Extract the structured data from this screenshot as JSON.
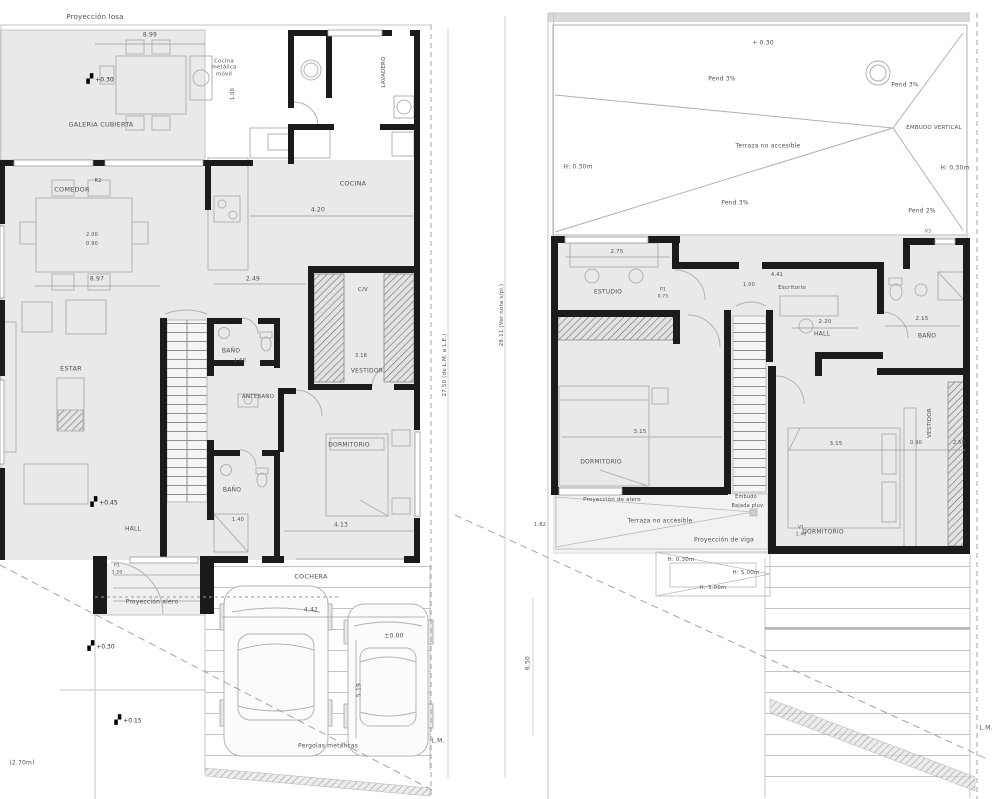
{
  "colors": {
    "wall": "#1b1b1b",
    "furniture_line": "#b3b3b3",
    "dim_line": "#999999",
    "room_fill": "#e9e9e9",
    "text": "#4f4f4f"
  },
  "glyphs": {
    "level_marker": "▞"
  },
  "markers": [
    {
      "t": "+0.30",
      "x": 100,
      "y": 80
    },
    {
      "t": "+0.45",
      "x": 104,
      "y": 503
    },
    {
      "t": "+0.30",
      "x": 101,
      "y": 647
    },
    {
      "t": "+0.15",
      "x": 128,
      "y": 721
    }
  ],
  "labels": [
    {
      "t": "Proyección losa",
      "x": 95,
      "y": 17,
      "s": 7
    },
    {
      "t": "8.99",
      "x": 150,
      "y": 36,
      "s": 6
    },
    {
      "t": "Cocina\nmetálica\nmóvil",
      "x": 224,
      "y": 68,
      "s": 5.5
    },
    {
      "t": "1.00",
      "x": 234,
      "y": 94,
      "s": 5,
      "r": -90
    },
    {
      "t": "GALERIA CUBIERTA",
      "x": 101,
      "y": 125,
      "s": 6.5,
      "n": "room-label-galeria"
    },
    {
      "t": "R2",
      "x": 98,
      "y": 182,
      "s": 5
    },
    {
      "t": "COMEDOR",
      "x": 72,
      "y": 190,
      "s": 6.5,
      "n": "room-label-comedor"
    },
    {
      "t": "2.00",
      "x": 92,
      "y": 236,
      "s": 5
    },
    {
      "t": "0.90",
      "x": 92,
      "y": 245,
      "s": 5
    },
    {
      "t": "8.97",
      "x": 97,
      "y": 280,
      "s": 6
    },
    {
      "t": "ESTAR",
      "x": 71,
      "y": 369,
      "s": 6.5,
      "n": "room-label-estar"
    },
    {
      "t": "COCINA",
      "x": 353,
      "y": 184,
      "s": 6.5,
      "n": "room-label-cocina"
    },
    {
      "t": "LAVADERO",
      "x": 384,
      "y": 72,
      "s": 5.5,
      "r": -90,
      "n": "room-label-lavadero"
    },
    {
      "t": "4.20",
      "x": 318,
      "y": 211,
      "s": 6
    },
    {
      "t": "2.49",
      "x": 253,
      "y": 280,
      "s": 6
    },
    {
      "t": "C/V",
      "x": 363,
      "y": 290,
      "s": 5.5
    },
    {
      "t": "3.18",
      "x": 361,
      "y": 357,
      "s": 5
    },
    {
      "t": "VESTIDOR",
      "x": 367,
      "y": 372,
      "s": 6,
      "n": "room-label-vestidor-pb"
    },
    {
      "t": "BAÑO",
      "x": 231,
      "y": 352,
      "s": 6,
      "n": "room-label-banio-1"
    },
    {
      "t": "1.60",
      "x": 240,
      "y": 362,
      "s": 5
    },
    {
      "t": "ANTEBAÑO",
      "x": 258,
      "y": 397,
      "s": 5.5,
      "n": "room-label-antebanio"
    },
    {
      "t": "BAÑO",
      "x": 232,
      "y": 491,
      "s": 6,
      "n": "room-label-banio-2"
    },
    {
      "t": "1.40",
      "x": 238,
      "y": 521,
      "s": 5
    },
    {
      "t": "DORMITORIO",
      "x": 349,
      "y": 446,
      "s": 6,
      "n": "room-label-dormitorio-pb"
    },
    {
      "t": "4.13",
      "x": 341,
      "y": 526,
      "s": 6
    },
    {
      "t": "HALL",
      "x": 133,
      "y": 530,
      "s": 6,
      "n": "room-label-hall-pb"
    },
    {
      "t": "P1",
      "x": 117,
      "y": 566,
      "s": 4.5
    },
    {
      "t": "1.20",
      "x": 117,
      "y": 573,
      "s": 4.5
    },
    {
      "t": "Proyección alero",
      "x": 152,
      "y": 603,
      "s": 6
    },
    {
      "t": "COCHERA",
      "x": 311,
      "y": 577,
      "s": 6.5,
      "n": "room-label-cochera"
    },
    {
      "t": "4.42",
      "x": 311,
      "y": 611,
      "s": 6
    },
    {
      "t": "±0.00",
      "x": 394,
      "y": 637,
      "s": 6
    },
    {
      "t": "5.19",
      "x": 360,
      "y": 690,
      "s": 6,
      "r": -90
    },
    {
      "t": "Pergolas metalicas",
      "x": 328,
      "y": 747,
      "s": 6
    },
    {
      "t": "L.M.",
      "x": 438,
      "y": 742,
      "s": 6
    },
    {
      "t": "(2.70m)",
      "x": 22,
      "y": 764,
      "s": 6
    },
    {
      "t": "27.50 (de L.M. a L.E.)",
      "x": 445,
      "y": 365,
      "s": 5.5,
      "r": -90
    },
    {
      "t": "28.11 (Ver nota s/pl.)",
      "x": 502,
      "y": 315,
      "s": 5.5,
      "r": -90
    },
    {
      "t": "1.82",
      "x": 540,
      "y": 526,
      "s": 5
    },
    {
      "t": "6.50",
      "x": 529,
      "y": 663,
      "s": 6,
      "r": -90
    },
    {
      "t": "+ 0.30",
      "x": 763,
      "y": 44,
      "s": 6
    },
    {
      "t": "Pend 3%",
      "x": 722,
      "y": 80,
      "s": 6
    },
    {
      "t": "Pend 3%",
      "x": 905,
      "y": 86,
      "s": 6
    },
    {
      "t": "EMBUDO VERTICAL",
      "x": 934,
      "y": 128,
      "s": 5.5
    },
    {
      "t": "Terraza no accesible",
      "x": 768,
      "y": 147,
      "s": 6
    },
    {
      "t": "H: 0.30m",
      "x": 578,
      "y": 168,
      "s": 6
    },
    {
      "t": "H: 0.30m",
      "x": 955,
      "y": 169,
      "s": 6
    },
    {
      "t": "Pend 3%",
      "x": 735,
      "y": 204,
      "s": 6
    },
    {
      "t": "Pend 2%",
      "x": 922,
      "y": 212,
      "s": 6
    },
    {
      "t": "V3",
      "x": 928,
      "y": 232,
      "s": 4.5
    },
    {
      "t": "2.75",
      "x": 617,
      "y": 252,
      "s": 5.5
    },
    {
      "t": "ESTUDIO",
      "x": 608,
      "y": 293,
      "s": 6,
      "n": "room-label-estudio"
    },
    {
      "t": "P1",
      "x": 663,
      "y": 290,
      "s": 4.5
    },
    {
      "t": "0.75",
      "x": 663,
      "y": 297,
      "s": 4.5
    },
    {
      "t": "1.00",
      "x": 749,
      "y": 286,
      "s": 5
    },
    {
      "t": "4.41",
      "x": 777,
      "y": 276,
      "s": 5
    },
    {
      "t": "Escritorio",
      "x": 792,
      "y": 288,
      "s": 5.5,
      "n": "room-label-escritorio"
    },
    {
      "t": "2.20",
      "x": 825,
      "y": 322,
      "s": 5.5
    },
    {
      "t": "HALL",
      "x": 822,
      "y": 335,
      "s": 6,
      "n": "room-label-hall-pa"
    },
    {
      "t": "2.15",
      "x": 922,
      "y": 319,
      "s": 5.5
    },
    {
      "t": "BAÑO",
      "x": 927,
      "y": 337,
      "s": 6,
      "n": "room-label-banio-pa"
    },
    {
      "t": "3.15",
      "x": 640,
      "y": 432,
      "s": 5.5
    },
    {
      "t": "DORMITORIO",
      "x": 601,
      "y": 463,
      "s": 6,
      "n": "room-label-dormitorio-1-pa"
    },
    {
      "t": "Proyección de alero",
      "x": 612,
      "y": 500,
      "s": 5.5
    },
    {
      "t": "Embudo",
      "x": 746,
      "y": 498,
      "s": 5
    },
    {
      "t": "Bajada pluv.",
      "x": 748,
      "y": 507,
      "s": 5
    },
    {
      "t": "Terraza no accesible",
      "x": 660,
      "y": 522,
      "s": 6
    },
    {
      "t": "Proyección de viga",
      "x": 724,
      "y": 541,
      "s": 6
    },
    {
      "t": "H: 0.30m",
      "x": 681,
      "y": 560,
      "s": 5.5
    },
    {
      "t": "H: 5.00m",
      "x": 746,
      "y": 573,
      "s": 5.5
    },
    {
      "t": "H: 3.00m",
      "x": 713,
      "y": 588,
      "s": 5.5
    },
    {
      "t": "3.15",
      "x": 836,
      "y": 444,
      "s": 5.5
    },
    {
      "t": "0.90",
      "x": 916,
      "y": 444,
      "s": 5
    },
    {
      "t": "2.50",
      "x": 959,
      "y": 444,
      "s": 5
    },
    {
      "t": "VESTIDOR",
      "x": 930,
      "y": 423,
      "s": 5.5,
      "r": -90,
      "n": "room-label-vestidor-pa"
    },
    {
      "t": "V1",
      "x": 801,
      "y": 528,
      "s": 4.5
    },
    {
      "t": "1.40",
      "x": 801,
      "y": 535,
      "s": 4.5
    },
    {
      "t": "DORMITORIO",
      "x": 823,
      "y": 533,
      "s": 6,
      "n": "room-label-dormitorio-2-pa"
    },
    {
      "t": "L.M.",
      "x": 986,
      "y": 729,
      "s": 6
    }
  ]
}
